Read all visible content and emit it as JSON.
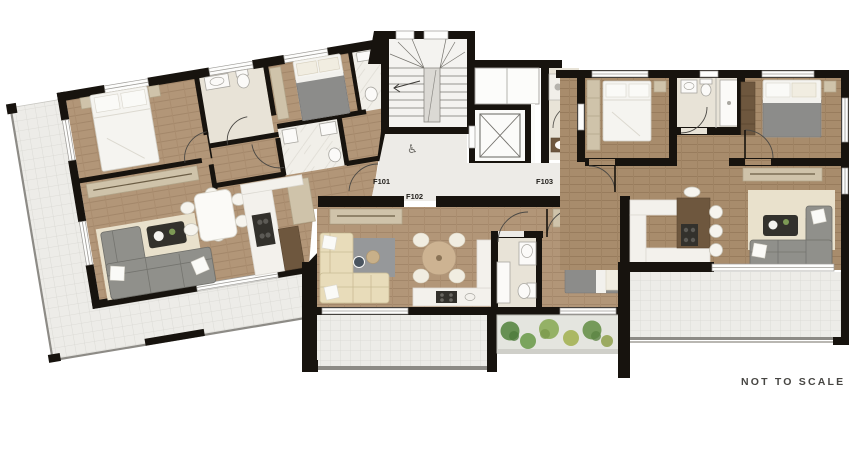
{
  "page": {
    "background": "#ffffff",
    "note": "NOT TO SCALE"
  },
  "plan": {
    "type": "apartment-floor-plan",
    "units": [
      {
        "id": "f101",
        "label": "F101"
      },
      {
        "id": "f102",
        "label": "F102"
      },
      {
        "id": "f103",
        "label": "F103"
      }
    ],
    "core": {
      "wheelchair_symbol": "♿"
    }
  },
  "colors": {
    "wall": "#17130e",
    "wood_floor": "#b29678",
    "wood_plank_line": "#a3876a",
    "wood_floor_dark": "#a88c6c",
    "tile": "#edecE8",
    "tile_line": "#d8d7d2",
    "bath_floor": "#e8e3d7",
    "core_floor": "#edebe7",
    "marble": "#f3f1ec",
    "rug_beige": "#e9e1cc",
    "rug_gray": "#96989a",
    "sofa_gray": "#90908b",
    "sofa_cream": "#e8dcba",
    "bed_white": "#f5f4f0",
    "blanket_gray": "#8c8c8a",
    "wardrobe_tan": "#cfc3aa",
    "dark_wood": "#6e573e",
    "plant_green_1": "#5f8b4a",
    "plant_green_2": "#8fae5f",
    "plant_green_3": "#a8b55c",
    "note_text": "#474643"
  }
}
